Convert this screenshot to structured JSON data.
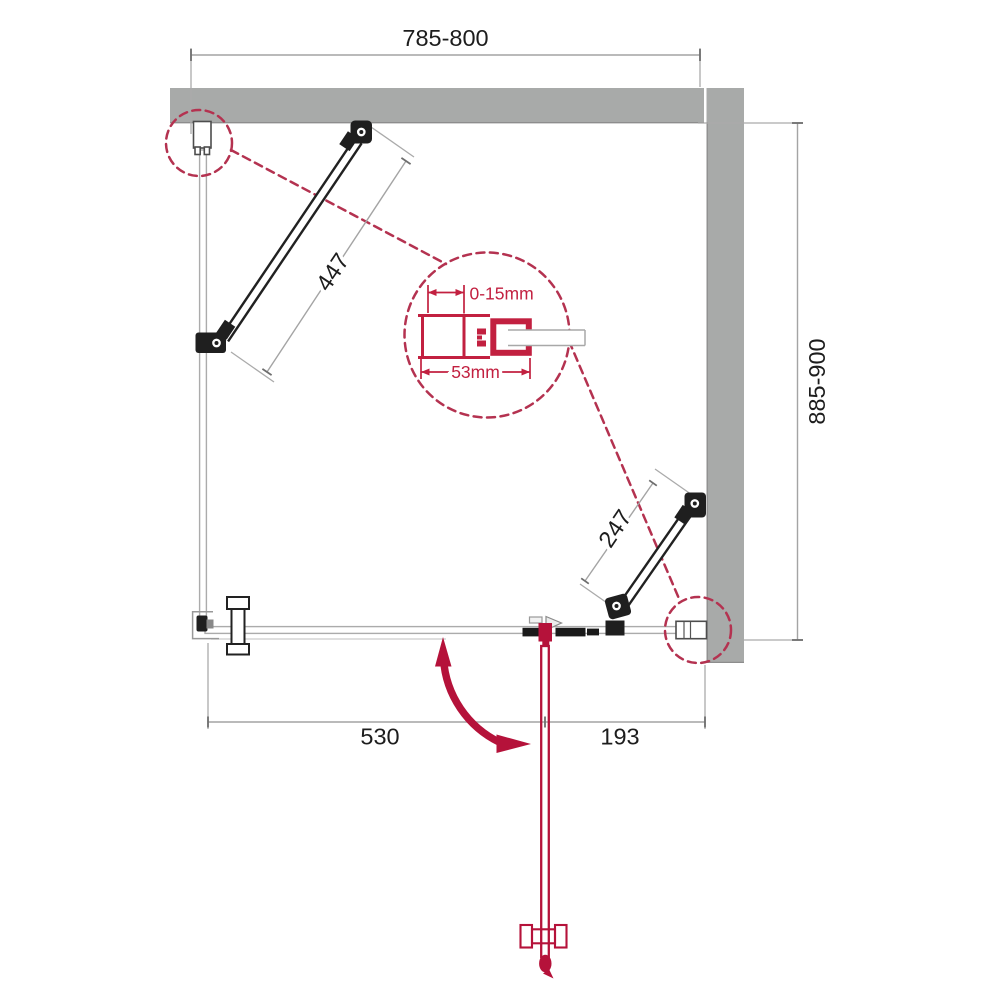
{
  "dimensions": {
    "top_width": "785-800",
    "side_depth": "885-900",
    "long_brace": "447",
    "short_brace": "247",
    "bottom_fixed_segment": "530",
    "bottom_door_segment": "193"
  },
  "detail_callout": {
    "adjustment_range": "0-15mm",
    "profile_width": "53mm"
  },
  "colors": {
    "wall_gray": "#a8aaa9",
    "hardware_black": "#1f1f1f",
    "glass_line_gray": "#ababab",
    "dimension_line_gray": "#a4a4a4",
    "text_black": "#1d1d1d",
    "callout_red": "#b43250",
    "profile_red": "#c22040",
    "door_red": "#b5123a"
  }
}
